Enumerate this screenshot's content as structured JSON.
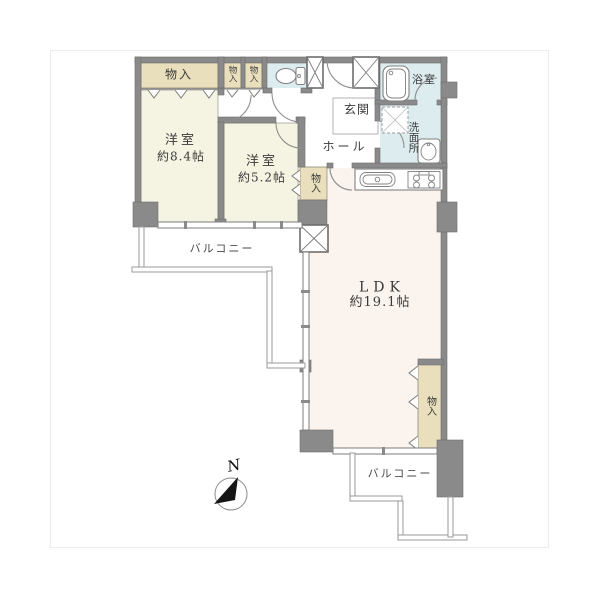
{
  "labels": {
    "bedroom1_name": "洋室",
    "bedroom1_size": "約8.4帖",
    "bedroom2_name": "洋室",
    "bedroom2_size": "約5.2帖",
    "ldk_name": "LDK",
    "ldk_size": "約19.1帖",
    "entrance": "玄関",
    "hall": "ホール",
    "bathroom": "浴室",
    "washroom": "洗面所",
    "balcony_left": "バルコニー",
    "balcony_bottom": "バルコニー",
    "storage_main": "物入",
    "storage_small_1": "物入",
    "storage_small_2": "物入",
    "storage_bedroom2": "物入",
    "storage_ldk": "物入",
    "compass_north": "N"
  },
  "icons": {
    "toilet": "toilet-icon",
    "bathtub": "bathtub-icon",
    "washer_pan": "washing-machine-pan-icon",
    "wash_basin": "wash-basin-icon",
    "kitchen_sink": "kitchen-sink-icon",
    "stove": "stove-icon",
    "north_arrow": "north-arrow-icon",
    "pillar_shaft": "x-shaft-icon"
  },
  "colors": {
    "wall": "#8a8a8a",
    "wall-edge": "#6d6d6d",
    "room-cream": "#f5f4e3",
    "room-pink": "#faf3ee",
    "closet": "#e9dfbc",
    "wet": "#dcecef",
    "frame": "#ececec",
    "text": "#3a3a3a"
  }
}
